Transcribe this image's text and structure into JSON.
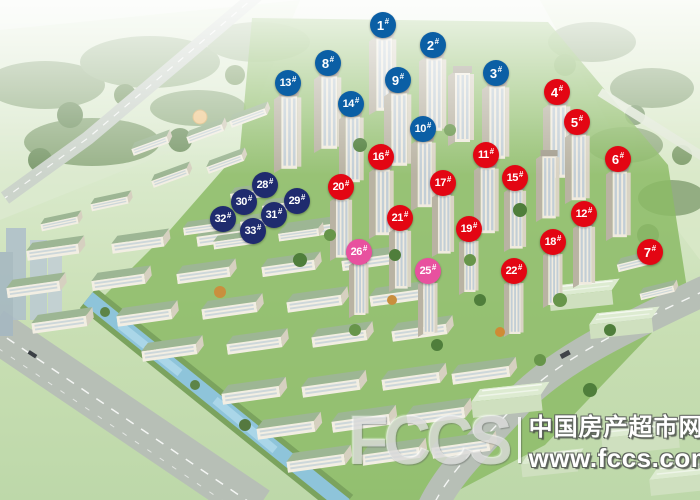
{
  "scene": {
    "palette": {
      "marker_blue": "#0b5fa5",
      "marker_red": "#e30613",
      "marker_navy": "#1f2b6e",
      "marker_pink": "#e8519f"
    }
  },
  "markers_suffix": "#",
  "markers": [
    {
      "label": "1#",
      "num": "1",
      "color": "blue",
      "x": 383,
      "y": 25
    },
    {
      "label": "2#",
      "num": "2",
      "color": "blue",
      "x": 433,
      "y": 45
    },
    {
      "label": "3#",
      "num": "3",
      "color": "blue",
      "x": 496,
      "y": 73
    },
    {
      "label": "4#",
      "num": "4",
      "color": "red",
      "x": 557,
      "y": 92
    },
    {
      "label": "5#",
      "num": "5",
      "color": "red",
      "x": 577,
      "y": 122
    },
    {
      "label": "6#",
      "num": "6",
      "color": "red",
      "x": 618,
      "y": 159
    },
    {
      "label": "7#",
      "num": "7",
      "color": "red",
      "x": 650,
      "y": 252
    },
    {
      "label": "8#",
      "num": "8",
      "color": "blue",
      "x": 328,
      "y": 63
    },
    {
      "label": "9#",
      "num": "9",
      "color": "blue",
      "x": 398,
      "y": 80
    },
    {
      "label": "10#",
      "num": "10",
      "color": "blue",
      "x": 423,
      "y": 129
    },
    {
      "label": "11#",
      "num": "11",
      "color": "red",
      "x": 486,
      "y": 155
    },
    {
      "label": "12#",
      "num": "12",
      "color": "red",
      "x": 584,
      "y": 214
    },
    {
      "label": "13#",
      "num": "13",
      "color": "blue",
      "x": 288,
      "y": 83
    },
    {
      "label": "14#",
      "num": "14",
      "color": "blue",
      "x": 351,
      "y": 104
    },
    {
      "label": "15#",
      "num": "15",
      "color": "red",
      "x": 515,
      "y": 178
    },
    {
      "label": "16#",
      "num": "16",
      "color": "red",
      "x": 381,
      "y": 157
    },
    {
      "label": "17#",
      "num": "17",
      "color": "red",
      "x": 443,
      "y": 183
    },
    {
      "label": "18#",
      "num": "18",
      "color": "red",
      "x": 553,
      "y": 242
    },
    {
      "label": "19#",
      "num": "19",
      "color": "red",
      "x": 469,
      "y": 229
    },
    {
      "label": "20#",
      "num": "20",
      "color": "red",
      "x": 341,
      "y": 187
    },
    {
      "label": "21#",
      "num": "21",
      "color": "red",
      "x": 400,
      "y": 218
    },
    {
      "label": "22#",
      "num": "22",
      "color": "red",
      "x": 514,
      "y": 271
    },
    {
      "label": "25#",
      "num": "25",
      "color": "pink",
      "x": 428,
      "y": 271
    },
    {
      "label": "26#",
      "num": "26",
      "color": "pink",
      "x": 359,
      "y": 252
    },
    {
      "label": "28#",
      "num": "28",
      "color": "navy",
      "x": 265,
      "y": 185
    },
    {
      "label": "29#",
      "num": "29",
      "color": "navy",
      "x": 297,
      "y": 201
    },
    {
      "label": "30#",
      "num": "30",
      "color": "navy",
      "x": 244,
      "y": 202
    },
    {
      "label": "31#",
      "num": "31",
      "color": "navy",
      "x": 274,
      "y": 215
    },
    {
      "label": "32#",
      "num": "32",
      "color": "navy",
      "x": 223,
      "y": 219
    },
    {
      "label": "33#",
      "num": "33",
      "color": "navy",
      "x": 253,
      "y": 231
    }
  ],
  "watermark": {
    "logo_text": "FCCS",
    "site_name": "中国房产超市网",
    "url": "www.fccs.com"
  }
}
